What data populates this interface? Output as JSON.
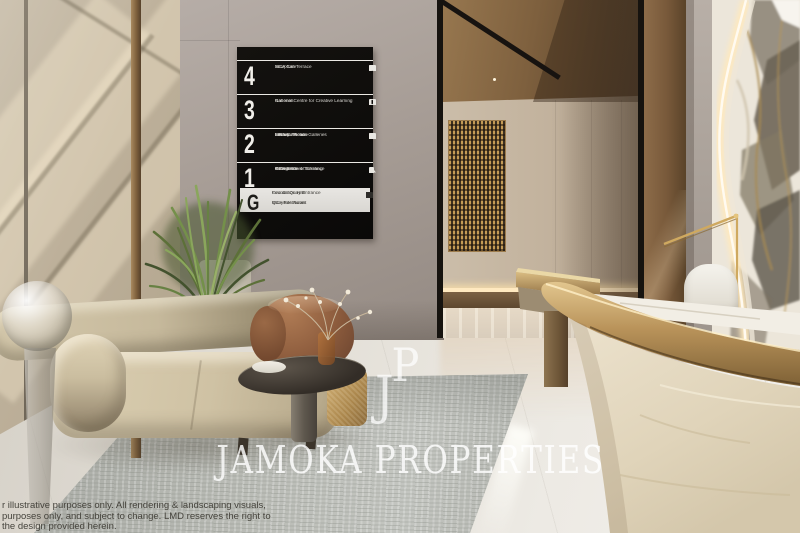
{
  "brand": {
    "monogram_top": "P",
    "monogram_bottom": "J",
    "name": "JAMOKA PROPERTIES"
  },
  "directory_board": {
    "rows": [
      {
        "level": "4",
        "line1": "Sculpture Terrace",
        "line2": "MCA Cafe",
        "icons": [
          "cafe-icon",
          "toilets-icon",
          "accessible-icon"
        ]
      },
      {
        "level": "3",
        "line1": "Galleries",
        "line2": "National Centre for Creative Learning",
        "icons": [
          "toilets-icon",
          "accessible-icon"
        ]
      },
      {
        "level": "2",
        "line1": "MCA Collection Galleries",
        "line2": "Lecture Theatre",
        "line3": "Seminar Room",
        "line4": "Library",
        "icons": [
          "lift-icon",
          "toilets-icon",
          "accessible-icon"
        ]
      },
      {
        "level": "1",
        "line1": "Galleries",
        "line2": "George Street Entrance",
        "line3": "Information & Ticketing",
        "line4": "MCA Store",
        "icons": [
          "store-icon",
          "cloakroom-icon",
          "info-icon"
        ]
      }
    ],
    "ground": {
      "level": "G",
      "group1_line1": "Circular Quay Entrance",
      "group1_line2": "Foundation Hall",
      "group2_line1": "MCA Restaurant",
      "group2_line2": "Quayside Room",
      "icons": [
        "toilets-icon",
        "escalator-icon"
      ]
    }
  },
  "disclaimer": {
    "line1": "r illustrative purposes only. All rendering & landscaping visuals,",
    "line2": "purposes only, and subject to change. LMD reserves the right to",
    "line3": "the design provided herein."
  },
  "colors": {
    "brass": "#b9935a",
    "board_black": "#0e0d0b",
    "board_text": "#e9e7e2",
    "marble_cream": "#ece6da",
    "wall_taupe": "#a79d96",
    "wall_beige": "#bfb29c",
    "watermark_white": "rgba(255,255,255,0.8)"
  }
}
